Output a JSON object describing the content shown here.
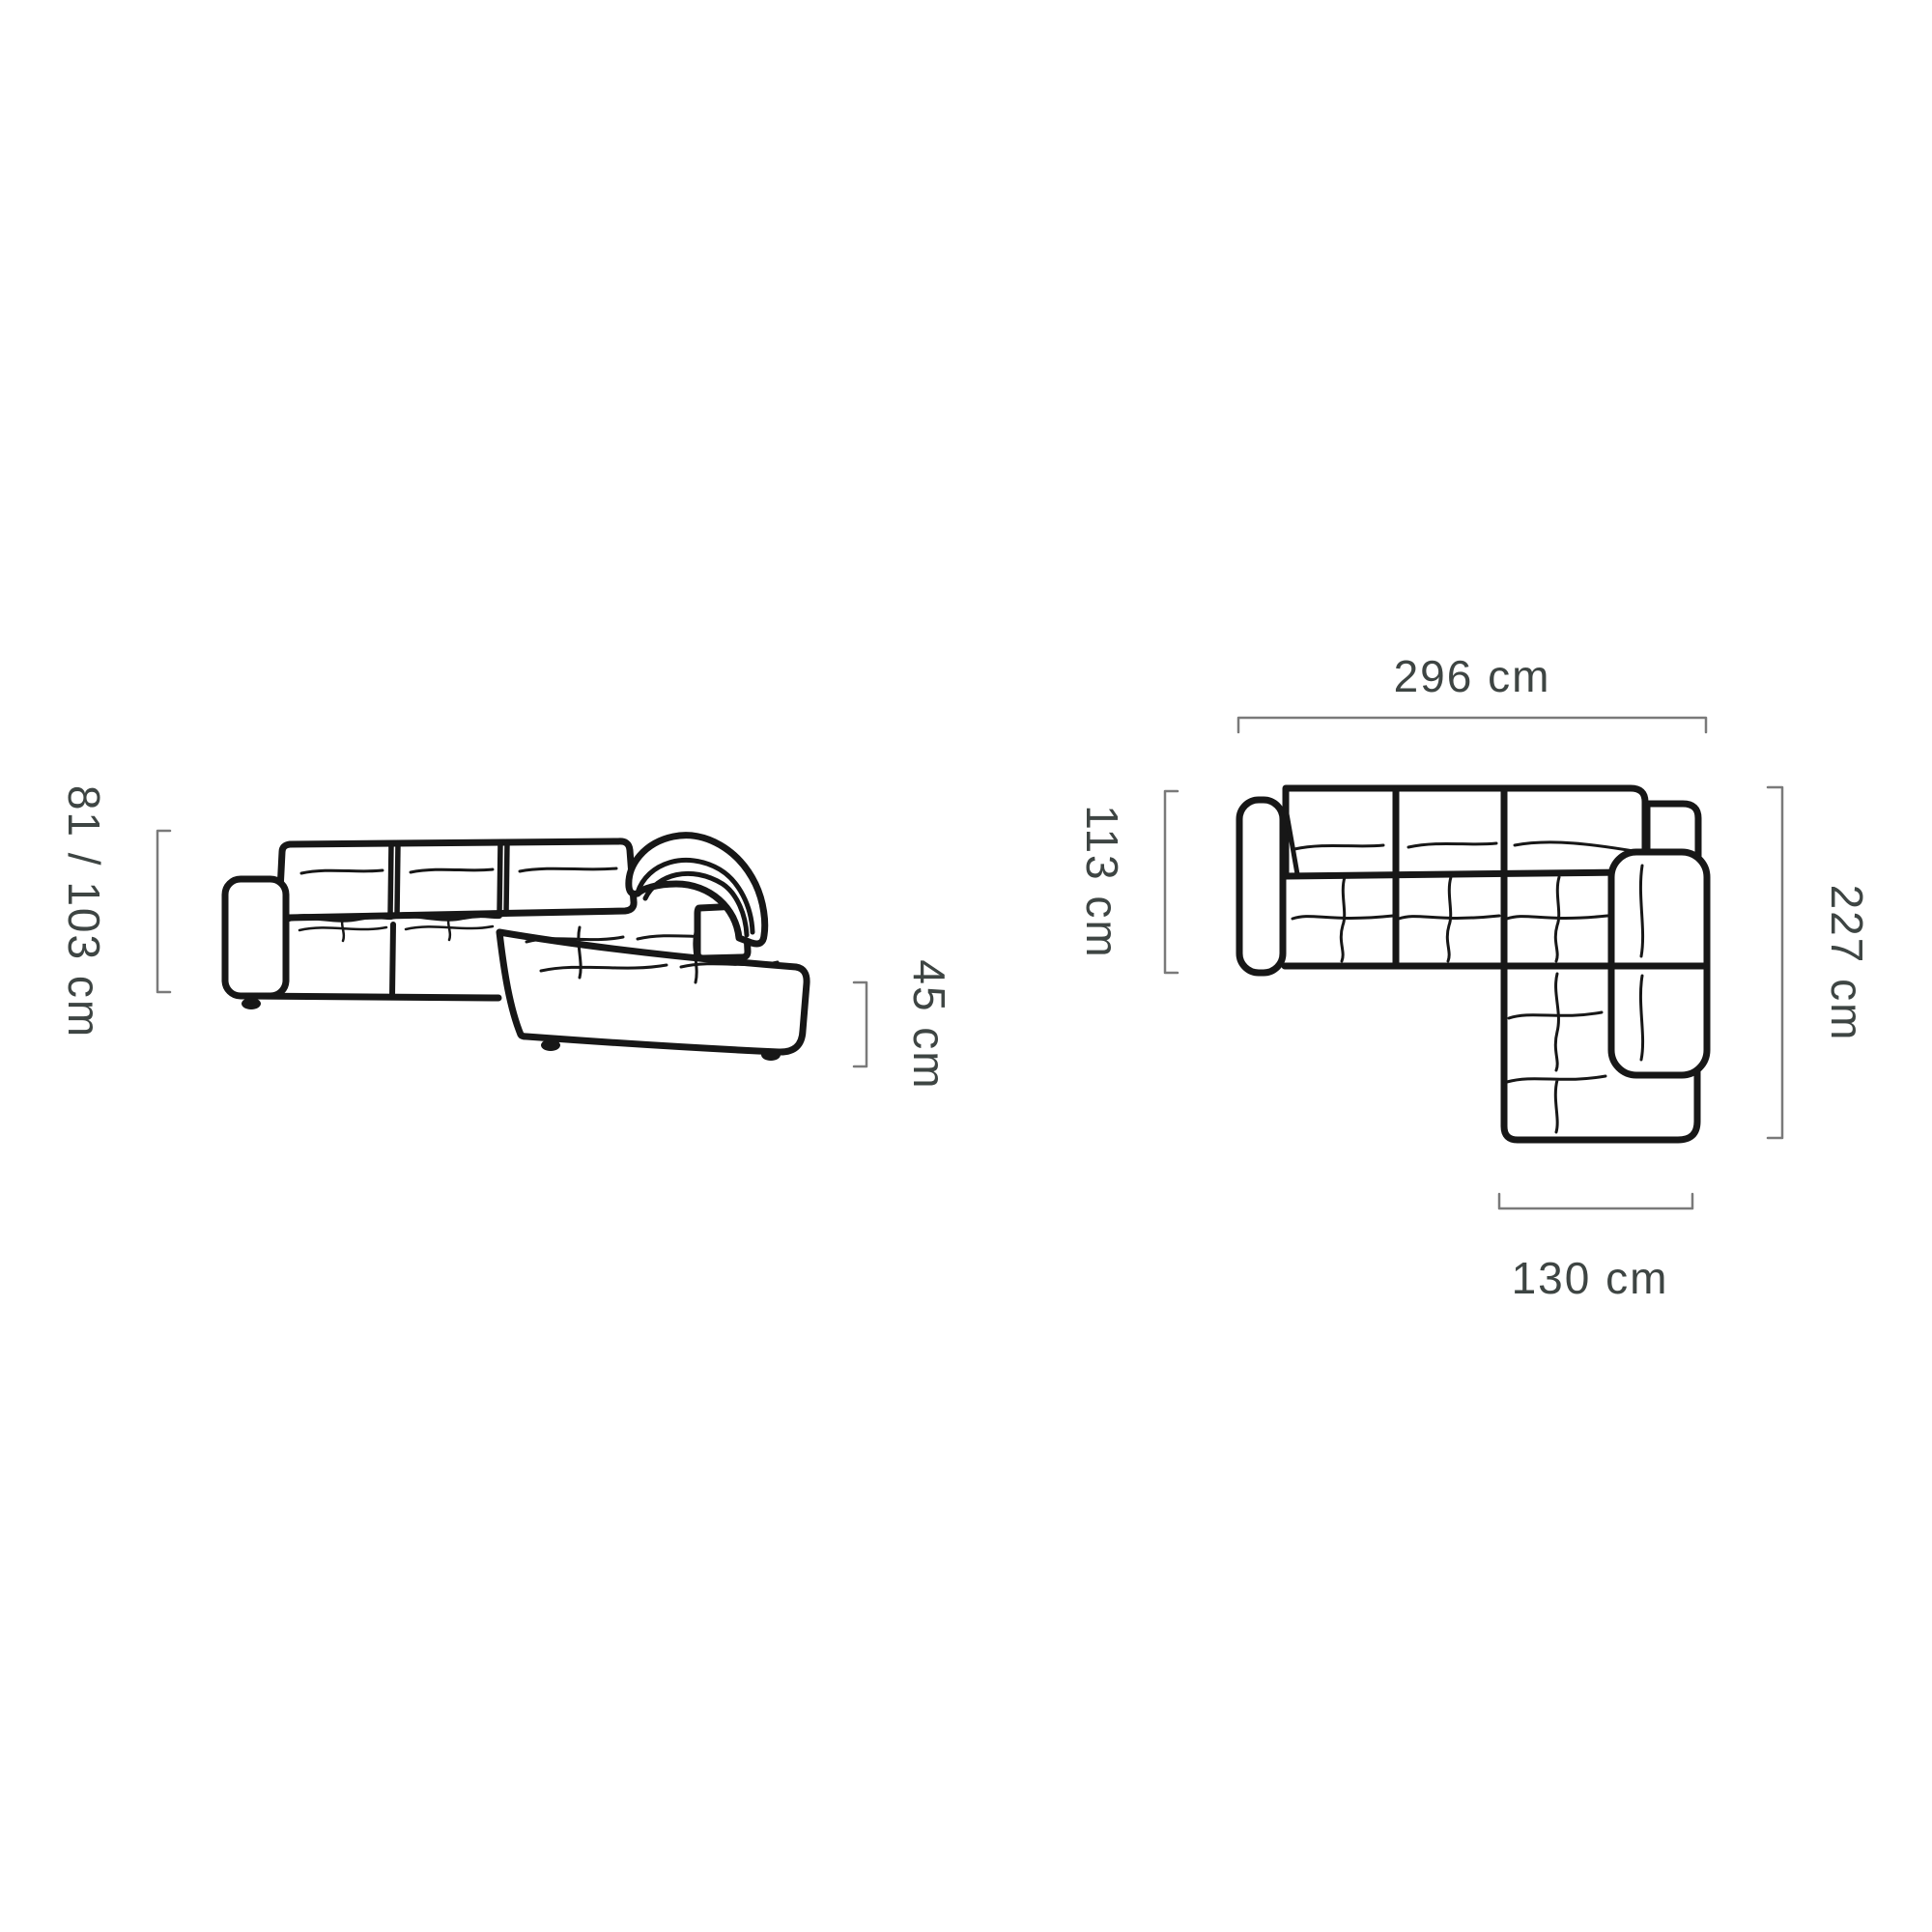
{
  "figure": {
    "background": "#ffffff",
    "line_color": "#171717",
    "dimension_line_color": "#7a7a7a",
    "label_color": "#3e4543",
    "side_view": {
      "name": "sofa-side-view",
      "height_label": "81 / 103 cm",
      "seat_height_label": "45 cm"
    },
    "top_view": {
      "name": "sofa-top-view",
      "width_label": "296 cm",
      "depth_label": "113 cm",
      "total_depth_label": "227 cm",
      "chaise_width_label": "130 cm"
    }
  }
}
